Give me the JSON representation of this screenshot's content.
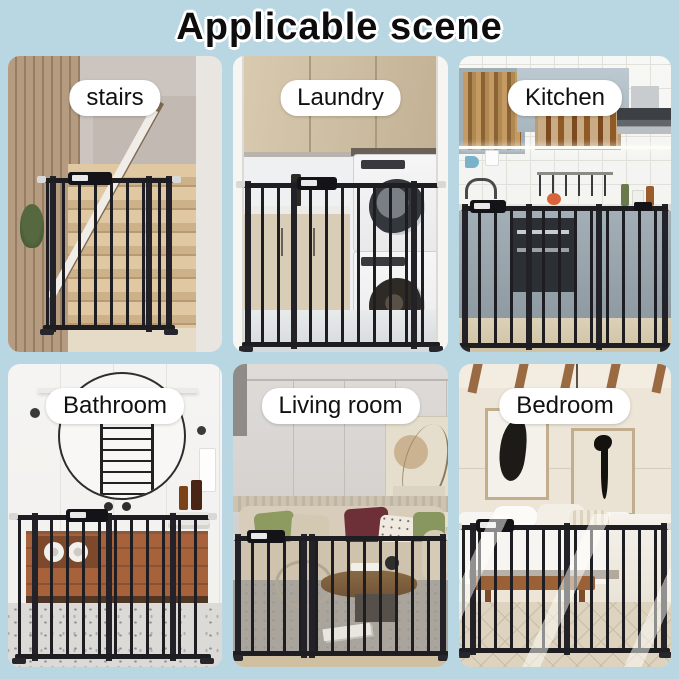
{
  "title": "Applicable scene",
  "panels": [
    {
      "id": "stairs",
      "label": "stairs"
    },
    {
      "id": "laundry",
      "label": "Laundry"
    },
    {
      "id": "kitchen",
      "label": "Kitchen"
    },
    {
      "id": "bathroom",
      "label": "Bathroom"
    },
    {
      "id": "living-room",
      "label": "Living room"
    },
    {
      "id": "bedroom",
      "label": "Bedroom"
    }
  ],
  "colors": {
    "background": "#b9d7e2",
    "title_text": "#0d0d0d",
    "title_outline": "#ffffff",
    "label_bg": "#ffffff",
    "label_text": "#111111",
    "gate_metal": "#1e1e22"
  }
}
